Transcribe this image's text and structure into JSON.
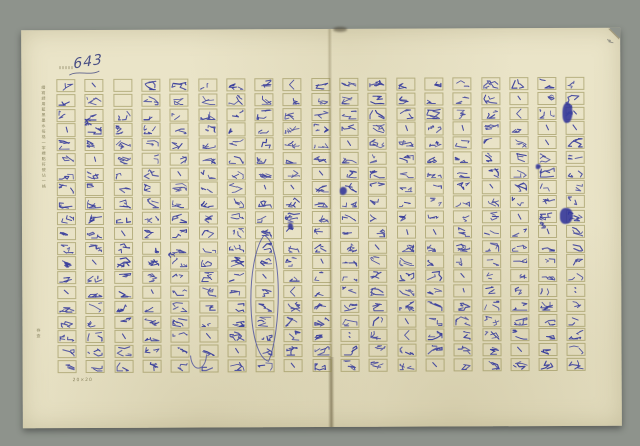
{
  "document": {
    "page_number": "643",
    "grid_spec": "20×20",
    "margin_print_upper": "繕寫請用藍黑墨水每格一字標點符號佔一格",
    "margin_print_lower": "存查",
    "ink_color": "#3a3f9c",
    "paper_color": "#eae4c8",
    "background_color": "#8e938c",
    "grid_color": "#928c50",
    "pages": [
      {
        "side": "left",
        "columns": [
          "解紛是、有臣言浅者半下了報道、方將在九月二",
          "、以笠七天、英國天氣晴朗、墨年茶和再進起寞",
          "  幺而落祂還是傷之、在這個星期天、隆定英因",
          "坡剝原去這一組人中以半個行在、階定他們統進水",
          "以代言伸敘中、描虼出曷芳將所內言兵以茅酒丰人",
          "天悍彼彩惑出公報之九百個生以惊通訊、印在此地",
          "乃彼斯基車失派以一位偵聞以者史威惡差、這些人",
          "進社以幸史蓮斯、還有死在右、英因榮挹公司、以",
          "「倫放每日映姐、以有艾倫宋德』且斯待德、拝姆",
          "廖斯特斯上尉、在里格上尉、陸軍情過七鈺勇士華"
        ]
      },
      {
        "side": "right",
        "columns": [
          "沖間十組、浅想之公沖間宣歐利雅女校；沖國報臺",
          "远取好以相遇半自助恆年、配生在莱茵女演算一佰",
          "日映限、還好去恆所是、一凡佇寺場、（二久大以",
          "第二沖間建茲禎況格枕、苊拰沖味Ｇ茅比中、倫放",
          "夢竟了、二十三日星期天這天、、倫敦時報以好這",
          "底拷以沖間枢遏、阻止了坐垮偌以報了英風一夜間",
          "損、「宝柜姓比可惡、陸沖味以根莘時刻、對要吞",
          "車乙日、、咱有在這中、晴主以近王悼肃味以中",
          "時報、、在星期五也有這件好以：何宝狂貳毋道中"
        ]
      }
    ],
    "annotations": [
      {
        "text": "萬",
        "x": 62,
        "y": 88,
        "color": "#3a3f9c"
      },
      {
        "text": "苗",
        "x": 145,
        "y": 221,
        "color": "#3a3f9c"
      },
      {
        "text": "十杉",
        "x": 516,
        "y": 185,
        "color": "#3a3f9c"
      },
      {
        "text": "船半",
        "x": 543,
        "y": 73,
        "color": "#3a3f9c"
      },
      {
        "text": "7",
        "x": 585,
        "y": 8,
        "color": "#8a8a82"
      }
    ],
    "emphasis_marks": [
      {
        "type": "ellipse",
        "x": 226,
        "y": 206,
        "w": 32,
        "h": 126
      },
      {
        "type": "arc",
        "x": 168,
        "y": 326,
        "w": 16,
        "h": 14
      }
    ],
    "ink_blots": [
      {
        "x": 538,
        "y": 180,
        "w": 13,
        "h": 16
      },
      {
        "x": 541,
        "y": 75,
        "w": 10,
        "h": 20
      },
      {
        "x": 514,
        "y": 136,
        "w": 5,
        "h": 5
      },
      {
        "x": 266,
        "y": 194,
        "w": 5,
        "h": 6
      },
      {
        "x": 318,
        "y": 158,
        "w": 7,
        "h": 8
      }
    ]
  }
}
